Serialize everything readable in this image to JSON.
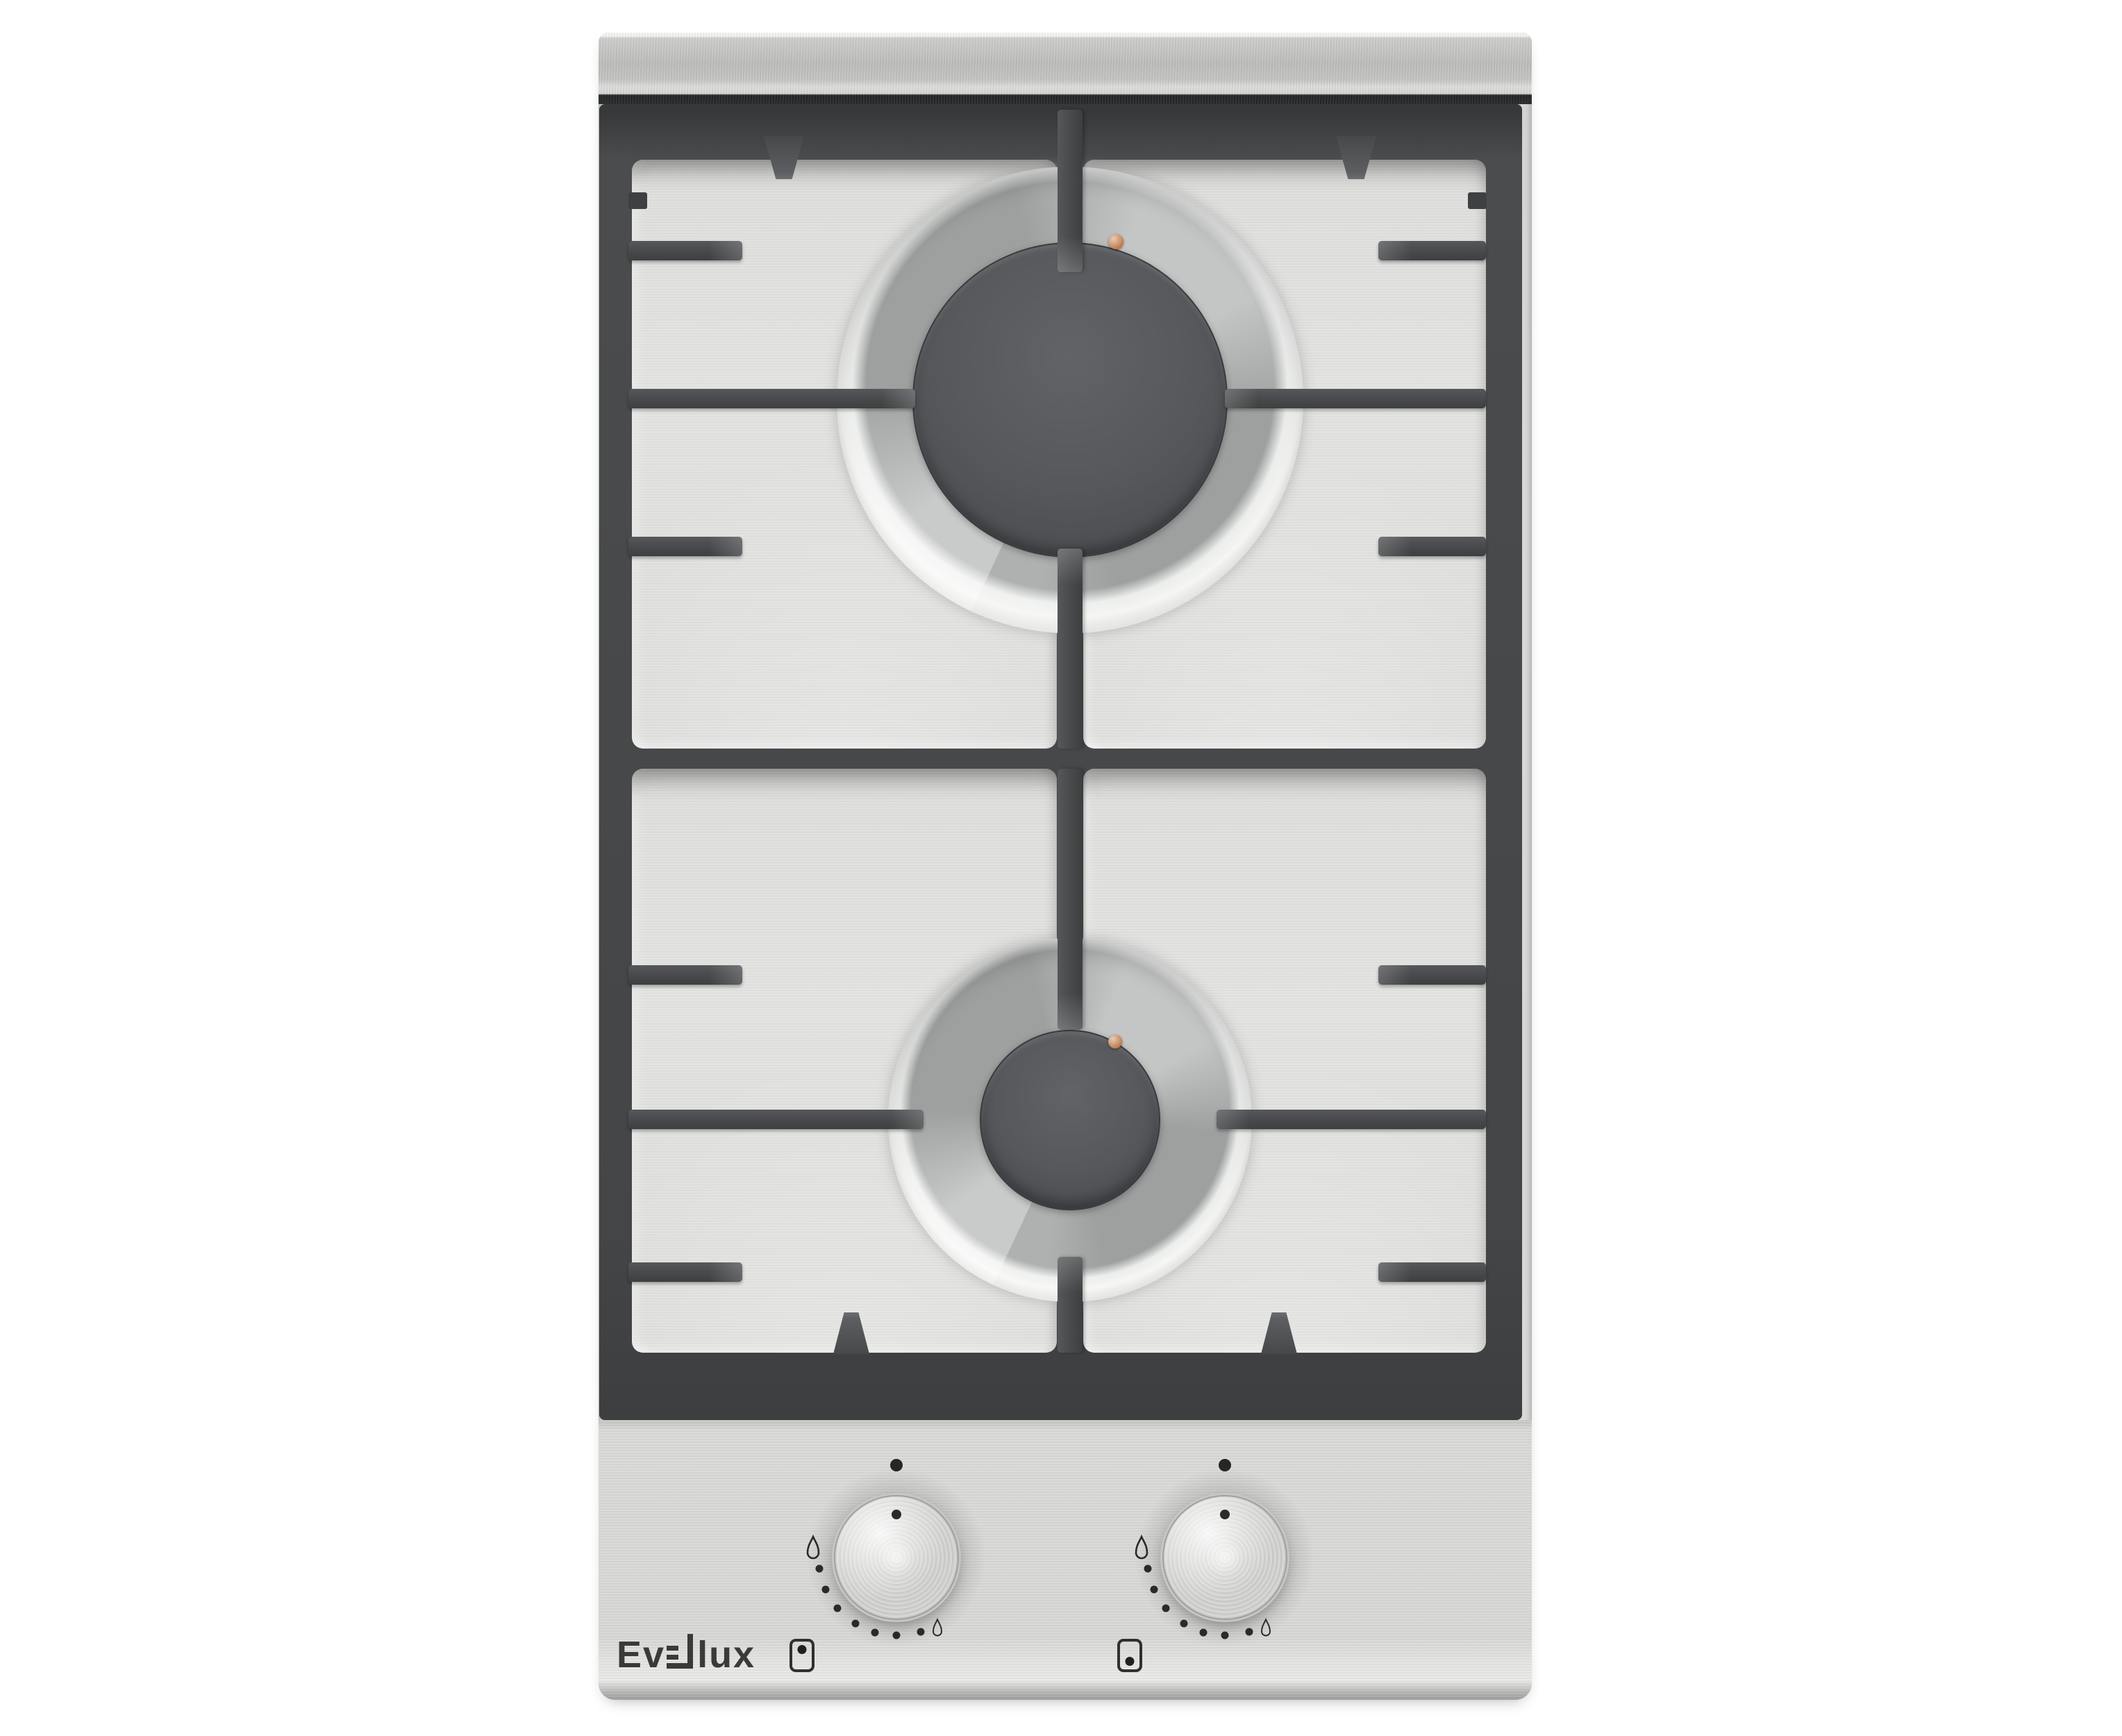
{
  "scene": {
    "description": "Product photo of a built-in two-burner domino gas hob on a white background",
    "background_color": "#ffffff"
  },
  "product": {
    "brand": "Evelux",
    "brand_prefix": "Ev",
    "brand_suffix": "lux",
    "category": "stainless steel 2-burner gas hob",
    "burners": [
      {
        "id": "rear",
        "size": "large",
        "cap_color": "#4c4e52",
        "igniter_color": "#c98f68"
      },
      {
        "id": "front",
        "size": "small",
        "cap_color": "#4c4e52",
        "igniter_color": "#c98f68"
      }
    ]
  },
  "colors": {
    "steel_light": "#e3e3e1",
    "steel_mid": "#d8d8d6",
    "grate_dark": "#47494b",
    "cap_gray": "#4f5155",
    "marking_ink": "#2a2a28",
    "igniter_copper": "#c98f68"
  },
  "knobs": [
    {
      "id": "rear-burner-knob",
      "controls": "rear burner",
      "state": "off",
      "pointer_deg": 0,
      "markings": {
        "off_dot_deg": 0,
        "flame_max_deg": 276,
        "flame_min_deg": 150,
        "dot_degs": [
          262,
          246,
          229,
          212,
          196,
          180,
          162
        ]
      },
      "icon": {
        "shape": "hob-outline",
        "dot_position": "top"
      }
    },
    {
      "id": "front-burner-knob",
      "controls": "front burner",
      "state": "off",
      "pointer_deg": 0,
      "markings": {
        "off_dot_deg": 0,
        "flame_max_deg": 276,
        "flame_min_deg": 150,
        "dot_degs": [
          262,
          246,
          229,
          212,
          196,
          180,
          162
        ]
      },
      "icon": {
        "shape": "hob-outline",
        "dot_position": "bottom"
      }
    }
  ]
}
